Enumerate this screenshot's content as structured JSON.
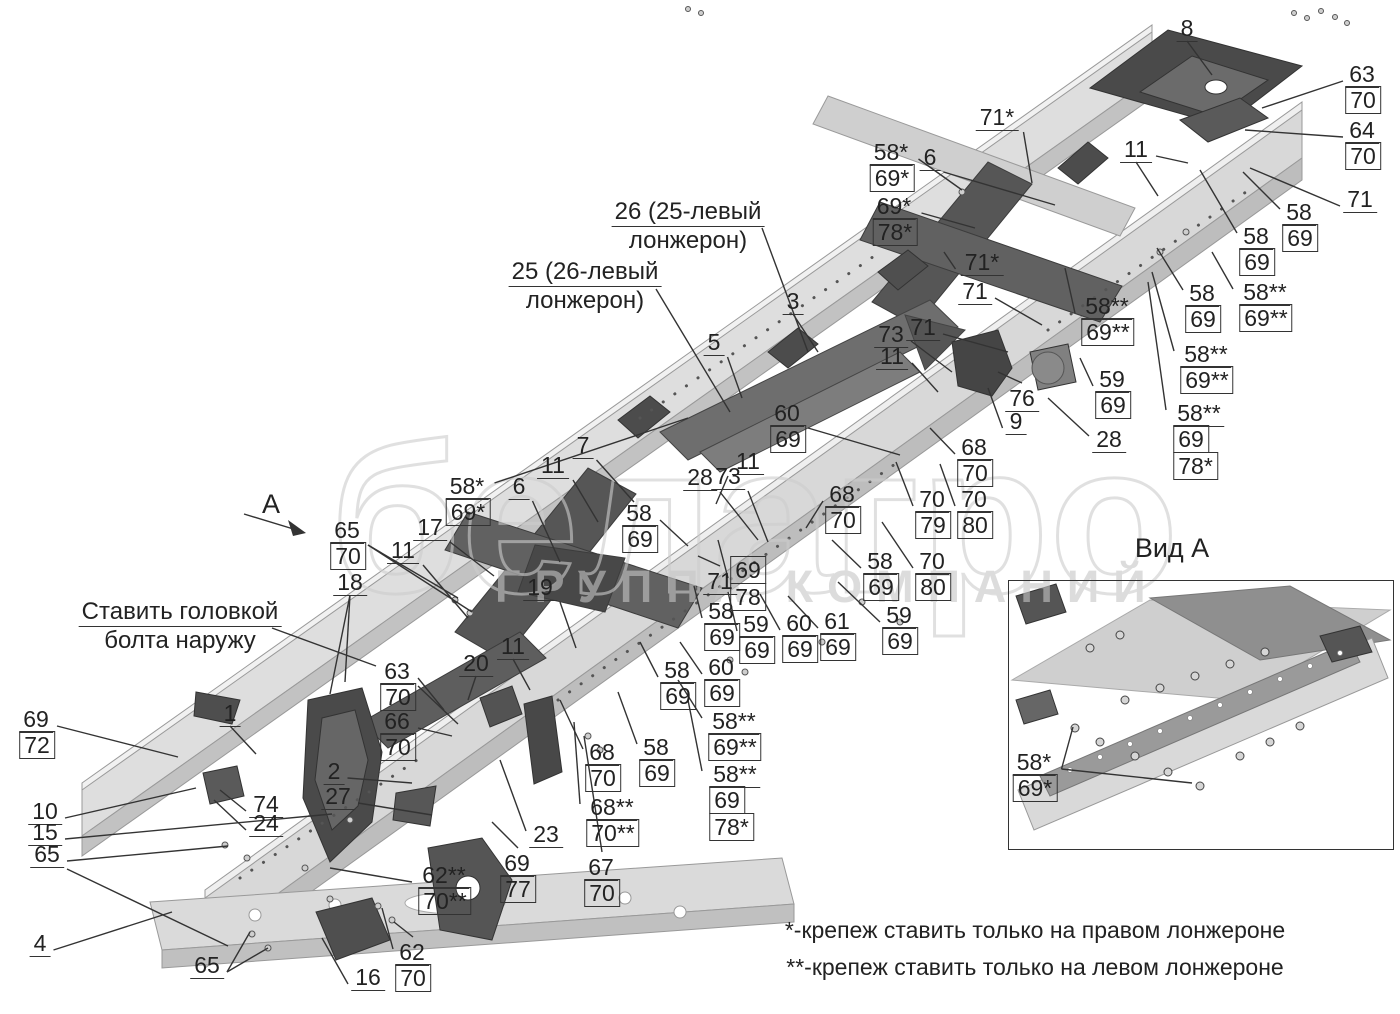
{
  "watermark": {
    "word": "белагро",
    "subtitle": "ГРУППА КОМПАНИЙ"
  },
  "view": {
    "letter": "А",
    "title": "Вид А"
  },
  "footnotes": {
    "line1": "*-крепеж ставить только на правом лонжероне",
    "line2": "**-крепеж ставить только на левом лонжероне"
  },
  "annotations": [
    {
      "cx": 688,
      "y": 198,
      "lines": [
        "26 (25-левый",
        "лонжерон)"
      ]
    },
    {
      "cx": 585,
      "y": 258,
      "lines": [
        "25 (26-левый",
        "лонжерон)"
      ]
    },
    {
      "cx": 180,
      "y": 598,
      "lines": [
        "Ставить головкой",
        "болта наружу"
      ]
    }
  ],
  "extra_lines": [
    [
      762,
      228,
      808,
      352
    ],
    [
      656,
      289,
      730,
      412
    ],
    [
      272,
      628,
      376,
      666
    ],
    [
      244,
      514,
      300,
      531
    ]
  ],
  "callouts": [
    {
      "x": 1187,
      "y": 29,
      "it": [
        "8"
      ],
      "tg": [
        [
          1212,
          75
        ]
      ]
    },
    {
      "x": 1363,
      "y": 75,
      "it": [
        "63",
        "#70"
      ],
      "tg": [
        [
          1262,
          108
        ]
      ]
    },
    {
      "x": 1363,
      "y": 131,
      "it": [
        "64",
        "#70"
      ],
      "tg": [
        [
          1245,
          130
        ]
      ]
    },
    {
      "x": 1360,
      "y": 200,
      "it": [
        "71"
      ],
      "tg": [
        [
          1250,
          168
        ]
      ]
    },
    {
      "x": 892,
      "y": 153,
      "it": [
        "58*",
        "#69*"
      ],
      "tg": [
        [
          962,
          190
        ]
      ]
    },
    {
      "x": 930,
      "y": 158,
      "it": [
        "6"
      ],
      "tg": [
        [
          1055,
          205
        ]
      ]
    },
    {
      "x": 895,
      "y": 207,
      "it": [
        "69*",
        "#78*"
      ],
      "tg": [
        [
          975,
          228
        ]
      ]
    },
    {
      "x": 997,
      "y": 118,
      "it": [
        "71*"
      ],
      "tg": [
        [
          1032,
          183
        ]
      ]
    },
    {
      "x": 1136,
      "y": 150,
      "it": [
        "11"
      ],
      "tg": [
        [
          1188,
          163
        ],
        [
          1158,
          196
        ]
      ]
    },
    {
      "x": 1300,
      "y": 213,
      "it": [
        "58",
        "#69"
      ],
      "tg": [
        [
          1243,
          172
        ]
      ]
    },
    {
      "x": 1257,
      "y": 237,
      "it": [
        "58",
        "#69"
      ],
      "tg": [
        [
          1200,
          170
        ]
      ]
    },
    {
      "x": 1203,
      "y": 294,
      "it": [
        "58",
        "#69"
      ],
      "tg": [
        [
          1157,
          248
        ]
      ]
    },
    {
      "x": 1266,
      "y": 293,
      "it": [
        "58**",
        "#69**"
      ],
      "tg": [
        [
          1212,
          252
        ]
      ]
    },
    {
      "x": 1207,
      "y": 355,
      "it": [
        "58**",
        "#69**"
      ],
      "tg": [
        [
          1152,
          272
        ]
      ]
    },
    {
      "x": 1113,
      "y": 380,
      "it": [
        "59",
        "#69"
      ],
      "tg": [
        [
          1080,
          358
        ]
      ]
    },
    {
      "x": 1199,
      "y": 414,
      "it": [
        "58**",
        "#69",
        "#78*"
      ],
      "tg": [
        [
          1148,
          282
        ]
      ]
    },
    {
      "x": 1022,
      "y": 399,
      "it": [
        "76"
      ],
      "tg": [
        [
          998,
          372
        ]
      ]
    },
    {
      "x": 1016,
      "y": 422,
      "it": [
        "9"
      ],
      "tg": [
        [
          988,
          388
        ]
      ]
    },
    {
      "x": 1109,
      "y": 440,
      "it": [
        "28"
      ],
      "tg": [
        [
          1048,
          398
        ]
      ]
    },
    {
      "x": 982,
      "y": 263,
      "it": [
        "71*"
      ],
      "tg": [
        [
          944,
          252
        ]
      ]
    },
    {
      "x": 975,
      "y": 292,
      "it": [
        "71"
      ],
      "tg": [
        [
          1042,
          325
        ]
      ]
    },
    {
      "x": 923,
      "y": 328,
      "it": [
        "71"
      ],
      "tg": [
        [
          1008,
          352
        ]
      ]
    },
    {
      "x": 891,
      "y": 335,
      "it": [
        "73"
      ],
      "tg": [
        [
          952,
          372
        ]
      ]
    },
    {
      "x": 892,
      "y": 357,
      "it": [
        "11"
      ],
      "tg": [
        [
          938,
          392
        ]
      ]
    },
    {
      "x": 793,
      "y": 302,
      "it": [
        "3"
      ],
      "tg": [
        [
          818,
          352
        ]
      ]
    },
    {
      "x": 714,
      "y": 343,
      "it": [
        "5"
      ],
      "tg": [
        [
          742,
          398
        ]
      ]
    },
    {
      "x": 788,
      "y": 414,
      "it": [
        "60",
        "#69"
      ],
      "tg": [
        [
          900,
          455
        ]
      ]
    },
    {
      "x": 1108,
      "y": 307,
      "it": [
        "58**",
        "#69**"
      ],
      "tg": [
        [
          1065,
          268
        ]
      ]
    },
    {
      "x": 583,
      "y": 446,
      "it": [
        "7"
      ],
      "tg": [
        [
          634,
          502
        ]
      ]
    },
    {
      "x": 553,
      "y": 466,
      "it": [
        "11"
      ],
      "tg": [
        [
          598,
          522
        ]
      ]
    },
    {
      "x": 519,
      "y": 487,
      "it": [
        "6"
      ],
      "tg": [
        [
          560,
          562
        ]
      ]
    },
    {
      "x": 468,
      "y": 487,
      "it": [
        "58*",
        "#69*"
      ],
      "tg": [
        [
          688,
          418
        ]
      ]
    },
    {
      "x": 348,
      "y": 531,
      "it": [
        "65",
        "#70"
      ],
      "tg": [
        [
          458,
          598
        ],
        [
          472,
          612
        ]
      ]
    },
    {
      "x": 430,
      "y": 528,
      "it": [
        "17"
      ],
      "tg": [
        [
          494,
          576
        ]
      ]
    },
    {
      "x": 403,
      "y": 551,
      "it": [
        "11"
      ],
      "tg": [
        [
          468,
          618
        ]
      ]
    },
    {
      "x": 350,
      "y": 583,
      "it": [
        "18"
      ],
      "tg": [
        [
          330,
          694
        ],
        [
          345,
          682
        ]
      ]
    },
    {
      "x": 540,
      "y": 588,
      "it": [
        "19"
      ],
      "tg": [
        [
          576,
          648
        ]
      ]
    },
    {
      "x": 230,
      "y": 714,
      "it": [
        "1"
      ],
      "tg": [
        [
          256,
          754
        ]
      ]
    },
    {
      "x": 37,
      "y": 720,
      "it": [
        "69",
        "#72"
      ],
      "tg": [
        [
          178,
          757
        ]
      ]
    },
    {
      "x": 45,
      "y": 812,
      "it": [
        "10"
      ],
      "tg": [
        [
          196,
          788
        ]
      ]
    },
    {
      "x": 45,
      "y": 833,
      "it": [
        "15"
      ],
      "tg": [
        [
          332,
          814
        ]
      ]
    },
    {
      "x": 47,
      "y": 855,
      "it": [
        "65"
      ],
      "tg": [
        [
          228,
          846
        ],
        [
          228,
          946
        ]
      ]
    },
    {
      "x": 266,
      "y": 805,
      "it": [
        "74"
      ],
      "tg": [
        [
          220,
          790
        ]
      ]
    },
    {
      "x": 266,
      "y": 824,
      "it": [
        "24"
      ],
      "tg": [
        [
          214,
          800
        ]
      ]
    },
    {
      "x": 334,
      "y": 772,
      "it": [
        "2"
      ],
      "tg": [
        [
          412,
          783
        ]
      ]
    },
    {
      "x": 338,
      "y": 797,
      "it": [
        "27"
      ],
      "tg": [
        [
          432,
          815
        ]
      ]
    },
    {
      "x": 398,
      "y": 672,
      "it": [
        "63",
        "#70"
      ],
      "tg": [
        [
          444,
          710
        ],
        [
          458,
          724
        ]
      ]
    },
    {
      "x": 398,
      "y": 722,
      "it": [
        "66",
        "#70"
      ],
      "tg": [
        [
          452,
          736
        ]
      ]
    },
    {
      "x": 476,
      "y": 664,
      "it": [
        "20"
      ],
      "tg": [
        [
          468,
          700
        ]
      ]
    },
    {
      "x": 513,
      "y": 647,
      "it": [
        "11"
      ],
      "tg": [
        [
          530,
          690
        ]
      ]
    },
    {
      "x": 546,
      "y": 835,
      "it": [
        "23"
      ],
      "tg": [
        [
          500,
          760
        ]
      ]
    },
    {
      "x": 518,
      "y": 864,
      "it": [
        "69",
        "#77"
      ],
      "tg": [
        [
          492,
          822
        ]
      ]
    },
    {
      "x": 445,
      "y": 876,
      "it": [
        "62**",
        "#70**"
      ],
      "tg": [
        [
          330,
          868
        ]
      ]
    },
    {
      "x": 207,
      "y": 966,
      "it": [
        "65"
      ],
      "tg": [
        [
          250,
          932
        ],
        [
          268,
          948
        ]
      ]
    },
    {
      "x": 40,
      "y": 944,
      "it": [
        "4"
      ],
      "tg": [
        [
          172,
          912
        ]
      ]
    },
    {
      "x": 368,
      "y": 978,
      "it": [
        "16"
      ],
      "tg": [
        [
          322,
          938
        ]
      ]
    },
    {
      "x": 413,
      "y": 953,
      "it": [
        "62",
        "#70"
      ],
      "tg": [
        [
          382,
          908
        ],
        [
          394,
          922
        ]
      ]
    },
    {
      "x": 603,
      "y": 753,
      "it": [
        "68",
        "#70"
      ],
      "tg": [
        [
          560,
          700
        ]
      ]
    },
    {
      "x": 657,
      "y": 748,
      "it": [
        "58",
        "#69"
      ],
      "tg": [
        [
          618,
          692
        ]
      ]
    },
    {
      "x": 613,
      "y": 808,
      "it": [
        "68**",
        "#70**"
      ],
      "tg": [
        [
          574,
          722
        ]
      ]
    },
    {
      "x": 602,
      "y": 868,
      "it": [
        "67",
        "#70"
      ],
      "tg": [
        [
          584,
          736
        ]
      ]
    },
    {
      "x": 735,
      "y": 722,
      "it": [
        "58**",
        "#69**"
      ],
      "tg": [
        [
          678,
          680
        ]
      ]
    },
    {
      "x": 735,
      "y": 775,
      "it": [
        "58**",
        "#69",
        "#78*"
      ],
      "tg": [
        [
          688,
          700
        ]
      ]
    },
    {
      "x": 678,
      "y": 671,
      "it": [
        "58",
        "#69"
      ],
      "tg": [
        [
          640,
          642
        ]
      ]
    },
    {
      "x": 722,
      "y": 668,
      "it": [
        "60",
        "#69"
      ],
      "tg": [
        [
          680,
          642
        ]
      ]
    },
    {
      "x": 722,
      "y": 612,
      "it": [
        "58",
        "#69"
      ],
      "tg": [
        [
          694,
          586
        ]
      ]
    },
    {
      "x": 757,
      "y": 625,
      "it": [
        "59",
        "#69"
      ],
      "tg": [
        [
          728,
          592
        ]
      ]
    },
    {
      "x": 800,
      "y": 624,
      "it": [
        "60",
        "#69"
      ],
      "tg": [
        [
          760,
          594
        ]
      ]
    },
    {
      "x": 838,
      "y": 622,
      "it": [
        "61",
        "#69"
      ],
      "tg": [
        [
          788,
          596
        ]
      ]
    },
    {
      "x": 900,
      "y": 616,
      "it": [
        "59",
        "#69"
      ],
      "tg": [
        [
          838,
          582
        ]
      ]
    },
    {
      "x": 881,
      "y": 562,
      "it": [
        "58",
        "#69"
      ],
      "tg": [
        [
          832,
          540
        ]
      ]
    },
    {
      "x": 748,
      "y": 572,
      "it": [
        "#69",
        "#78"
      ],
      "tg": [
        [
          718,
          540
        ]
      ]
    },
    {
      "x": 720,
      "y": 582,
      "it": [
        "71"
      ],
      "tg": [
        [
          698,
          556
        ]
      ]
    },
    {
      "x": 843,
      "y": 495,
      "it": [
        "68",
        "#70"
      ],
      "tg": [
        [
          806,
          528
        ]
      ]
    },
    {
      "x": 975,
      "y": 448,
      "it": [
        "68",
        "#70"
      ],
      "tg": [
        [
          930,
          428
        ]
      ]
    },
    {
      "x": 933,
      "y": 500,
      "it": [
        "70",
        "#79"
      ],
      "tg": [
        [
          896,
          462
        ]
      ]
    },
    {
      "x": 975,
      "y": 500,
      "it": [
        "70",
        "#80"
      ],
      "tg": [
        [
          940,
          464
        ]
      ]
    },
    {
      "x": 933,
      "y": 562,
      "it": [
        "70",
        "#80"
      ],
      "tg": [
        [
          882,
          522
        ]
      ]
    },
    {
      "x": 640,
      "y": 514,
      "it": [
        "58",
        "#69"
      ],
      "tg": [
        [
          688,
          546
        ]
      ]
    },
    {
      "x": 748,
      "y": 462,
      "it": [
        "11"
      ],
      "tg": [
        [
          716,
          504
        ]
      ]
    },
    {
      "x": 700,
      "y": 478,
      "it": [
        "28"
      ],
      "tg": [
        [
          758,
          540
        ]
      ]
    },
    {
      "x": 728,
      "y": 477,
      "it": [
        "73"
      ],
      "tg": [
        [
          768,
          542
        ]
      ]
    },
    {
      "x": 1035,
      "y": 763,
      "it": [
        "58*",
        "#69*"
      ],
      "tg": [
        [
          1073,
          727
        ],
        [
          1192,
          783
        ]
      ]
    }
  ]
}
